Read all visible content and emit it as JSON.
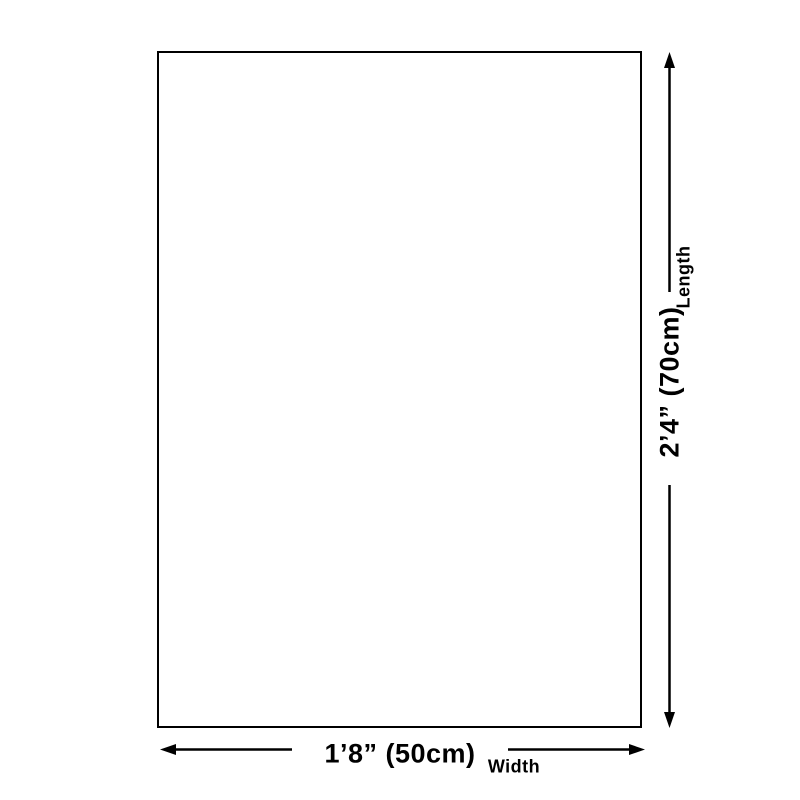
{
  "diagram": {
    "shape": "rectangle-size-guide",
    "width_dimension": {
      "value": "1’8” (50cm)",
      "label": "Width"
    },
    "length_dimension": {
      "value": "2’4” (70cm)",
      "label": "Length"
    }
  },
  "icons": {
    "length_arrow_up": "arrow-up-icon",
    "length_arrow_down": "arrow-down-icon",
    "width_arrow_left": "arrow-left-icon",
    "width_arrow_right": "arrow-right-icon"
  },
  "colors": {
    "background": "#ffffff",
    "line": "#000000",
    "text": "#000000"
  }
}
